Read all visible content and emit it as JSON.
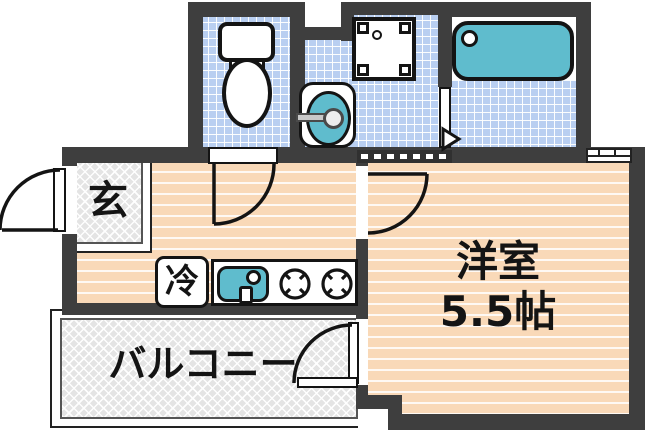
{
  "floorplan": {
    "type": "japanese-apartment-floorplan",
    "rooms": {
      "entrance": {
        "label": "玄"
      },
      "kitchen": {
        "fridge_label": "冷",
        "fixtures": [
          "refrigerator",
          "kitchen-sink",
          "stove-burners"
        ]
      },
      "western_room": {
        "label": "洋室",
        "area": "5.5帖"
      },
      "balcony": {
        "label": "バルコニー"
      },
      "toilet": {
        "fixtures": [
          "toilet"
        ]
      },
      "washroom": {
        "fixtures": [
          "washing-machine",
          "washbasin"
        ]
      },
      "bathroom": {
        "fixtures": [
          "bathtub"
        ]
      }
    },
    "colors": {
      "wall": "#3e3e3e",
      "tile_blue": "#b9cff1",
      "floor_peach": "#f9d9b8",
      "hatch_gray": "#e4e4e4",
      "fixture_teal": "#5fbccd",
      "outline_black": "#141414"
    }
  }
}
